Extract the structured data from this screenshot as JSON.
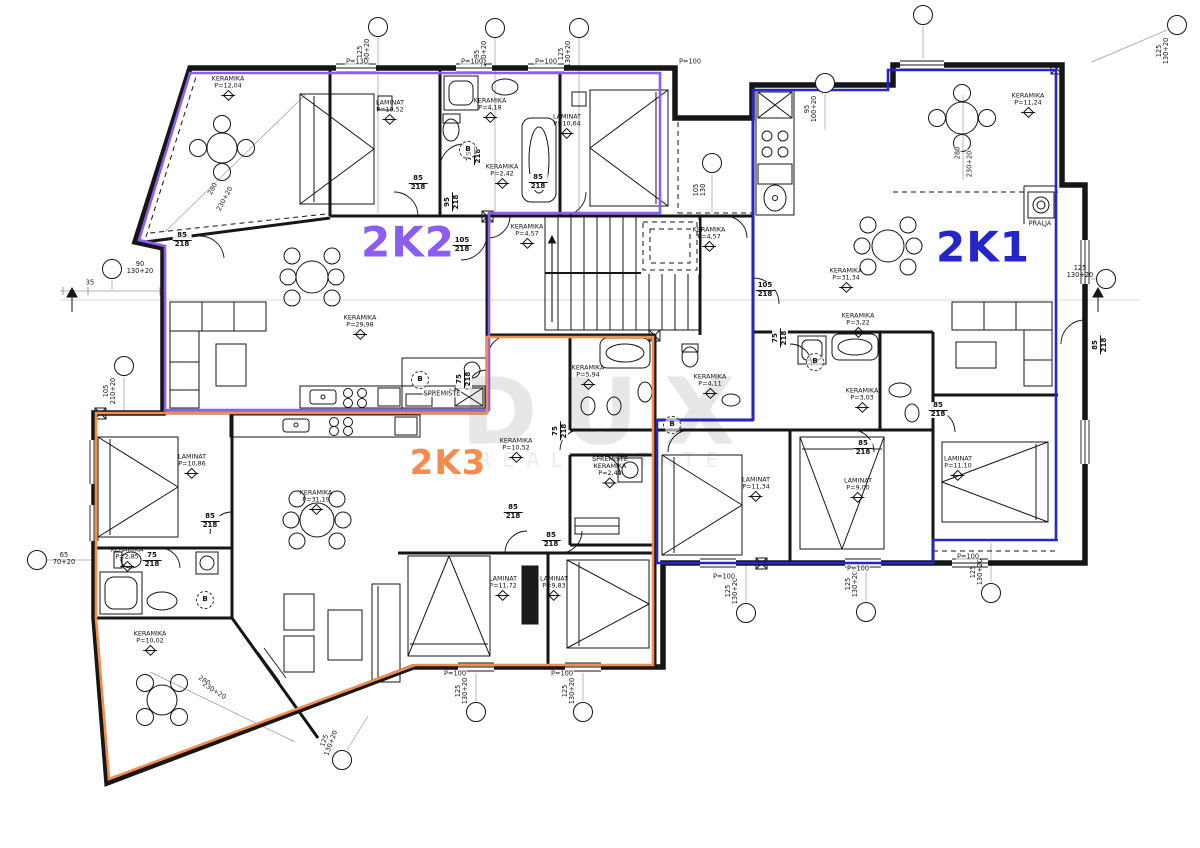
{
  "units": [
    {
      "id": "2K2",
      "color": "#8B5CF6",
      "x": 408,
      "y": 242,
      "size": 42
    },
    {
      "id": "2K1",
      "color": "#2525CE",
      "x": 983,
      "y": 247,
      "size": 42
    },
    {
      "id": "2K3",
      "color": "#F68B4E",
      "x": 448,
      "y": 463,
      "size": 34
    }
  ],
  "watermark": {
    "line1": "DUX",
    "line2": "REAL ESTATE"
  },
  "room_labels": [
    {
      "floor": "KERAMIKA",
      "area": "P=12,04",
      "x": 228,
      "y": 88
    },
    {
      "floor": "LAMINAT",
      "area": "P=10,52",
      "x": 390,
      "y": 112
    },
    {
      "floor": "KERAMIKA",
      "area": "P=4,18",
      "x": 490,
      "y": 110
    },
    {
      "floor": "LAMINAT",
      "area": "P=10,64",
      "x": 567,
      "y": 126
    },
    {
      "floor": "KERAMIKA",
      "area": "P=2,42",
      "x": 502,
      "y": 176
    },
    {
      "floor": "KERAMIKA",
      "area": "P=29,98",
      "x": 360,
      "y": 327
    },
    {
      "floor": "KERAMIKA",
      "area": "P=4,57",
      "x": 527,
      "y": 236
    },
    {
      "floor": "KERAMIKA",
      "area": "P=4,57",
      "x": 709,
      "y": 239
    },
    {
      "floor": "KERAMIKA",
      "area": "P=11,24",
      "x": 1028,
      "y": 105
    },
    {
      "floor": "KERAMIKA",
      "area": "P=31,34",
      "x": 846,
      "y": 280
    },
    {
      "floor": "KERAMIKA",
      "area": "P=3,22",
      "x": 858,
      "y": 325
    },
    {
      "floor": "KERAMIKA",
      "area": "P=4,11",
      "x": 710,
      "y": 386
    },
    {
      "floor": "KERAMIKA",
      "area": "P=3,03",
      "x": 862,
      "y": 400
    },
    {
      "floor": "LAMINAT",
      "area": "P=11,34",
      "x": 756,
      "y": 489
    },
    {
      "floor": "LAMINAT",
      "area": "P=9,00",
      "x": 858,
      "y": 490
    },
    {
      "floor": "LAMINAT",
      "area": "P=11,10",
      "x": 958,
      "y": 468
    },
    {
      "floor": "KERAMIKA",
      "area": "P=5,94",
      "x": 588,
      "y": 377
    },
    {
      "floor": "SPREMIŠTE KERAMIKA",
      "area": "P=2,40",
      "x": 610,
      "y": 472
    },
    {
      "floor": "KERAMIKA",
      "area": "P=10,52",
      "x": 516,
      "y": 450
    },
    {
      "floor": "KERAMIKA",
      "area": "P=31,19",
      "x": 316,
      "y": 502
    },
    {
      "floor": "LAMINAT",
      "area": "P=10,86",
      "x": 192,
      "y": 466
    },
    {
      "floor": "KERAMIKA",
      "area": "P=2,85",
      "x": 127,
      "y": 559
    },
    {
      "floor": "KERAMIKA",
      "area": "P=10,02",
      "x": 150,
      "y": 643
    },
    {
      "floor": "LAMINAT",
      "area": "P=11,72",
      "x": 503,
      "y": 588
    },
    {
      "floor": "LAMINAT",
      "area": "P=9,83",
      "x": 554,
      "y": 588
    }
  ],
  "door_labels": [
    {
      "top": "85",
      "bottom": "218",
      "x": 418,
      "y": 183,
      "rot": 0
    },
    {
      "top": "75",
      "bottom": "218",
      "x": 474,
      "y": 156,
      "rot": -90
    },
    {
      "top": "85",
      "bottom": "218",
      "x": 538,
      "y": 182,
      "rot": 0
    },
    {
      "top": "95",
      "bottom": "218",
      "x": 452,
      "y": 202,
      "rot": -90
    },
    {
      "top": "85",
      "bottom": "218",
      "x": 182,
      "y": 240,
      "rot": 0
    },
    {
      "top": "105",
      "bottom": "218",
      "x": 462,
      "y": 245,
      "rot": 0
    },
    {
      "top": "105",
      "bottom": "218",
      "x": 765,
      "y": 290,
      "rot": 0
    },
    {
      "top": "75",
      "bottom": "218",
      "x": 780,
      "y": 338,
      "rot": -90
    },
    {
      "top": "85",
      "bottom": "218",
      "x": 938,
      "y": 410,
      "rot": 0
    },
    {
      "top": "85",
      "bottom": "218",
      "x": 863,
      "y": 448,
      "rot": 0
    },
    {
      "top": "85",
      "bottom": "218",
      "x": 210,
      "y": 521,
      "rot": 0
    },
    {
      "top": "75",
      "bottom": "218",
      "x": 152,
      "y": 560,
      "rot": 0
    },
    {
      "top": "75",
      "bottom": "218",
      "x": 560,
      "y": 431,
      "rot": -90
    },
    {
      "top": "75",
      "bottom": "218",
      "x": 464,
      "y": 379,
      "rot": -90
    },
    {
      "top": "85",
      "bottom": "218",
      "x": 513,
      "y": 512,
      "rot": 0
    },
    {
      "top": "85",
      "bottom": "218",
      "x": 551,
      "y": 540,
      "rot": 0
    },
    {
      "top": "85",
      "bottom": "218",
      "x": 1100,
      "y": 345,
      "rot": -90
    }
  ],
  "axis_bubbles": [
    {
      "cx": 378,
      "cy": 27,
      "l1": "125",
      "l2": "130+20",
      "lx": 364,
      "ly": 52,
      "rot": -90
    },
    {
      "cx": 495,
      "cy": 28,
      "l1": "95",
      "l2": "100+20",
      "lx": 481,
      "ly": 54,
      "rot": -90
    },
    {
      "cx": 579,
      "cy": 28,
      "l1": "125",
      "l2": "130+20",
      "lx": 565,
      "ly": 54,
      "rot": -90
    },
    {
      "cx": 825,
      "cy": 83,
      "l1": "95",
      "l2": "100+20",
      "lx": 811,
      "ly": 109,
      "rot": -90
    },
    {
      "cx": 923,
      "cy": 15,
      "l1": "",
      "l2": "",
      "lx": 0,
      "ly": 0,
      "rot": 0
    },
    {
      "cx": 1177,
      "cy": 25,
      "l1": "125",
      "l2": "130+20",
      "lx": 1163,
      "ly": 51,
      "rot": -90
    },
    {
      "cx": 1106,
      "cy": 279,
      "l1": "125",
      "l2": "130+20",
      "lx": 1080,
      "ly": 272,
      "rot": 0
    },
    {
      "cx": 112,
      "cy": 269,
      "l1": "90",
      "l2": "130+20",
      "lx": 140,
      "ly": 268,
      "rot": 0
    },
    {
      "cx": 124,
      "cy": 366,
      "l1": "105",
      "l2": "210+20",
      "lx": 110,
      "ly": 391,
      "rot": -90
    },
    {
      "cx": 37,
      "cy": 560,
      "l1": "65",
      "l2": "70+20",
      "lx": 64,
      "ly": 559,
      "rot": 0
    },
    {
      "cx": 342,
      "cy": 760,
      "l1": "125",
      "l2": "130+20",
      "lx": 328,
      "ly": 742,
      "rot": -70
    },
    {
      "cx": 476,
      "cy": 712,
      "l1": "125",
      "l2": "130+20",
      "lx": 462,
      "ly": 691,
      "rot": -90
    },
    {
      "cx": 583,
      "cy": 712,
      "l1": "125",
      "l2": "130+20",
      "lx": 569,
      "ly": 691,
      "rot": -90
    },
    {
      "cx": 746,
      "cy": 613,
      "l1": "125",
      "l2": "130+20",
      "lx": 732,
      "ly": 591,
      "rot": -90
    },
    {
      "cx": 866,
      "cy": 612,
      "l1": "125",
      "l2": "130+20",
      "lx": 852,
      "ly": 584,
      "rot": -90
    },
    {
      "cx": 991,
      "cy": 593,
      "l1": "125",
      "l2": "130+20",
      "lx": 977,
      "ly": 572,
      "rot": -90
    },
    {
      "cx": 712,
      "cy": 163,
      "l1": "105",
      "l2": "130",
      "lx": 700,
      "ly": 190,
      "rot": -90
    }
  ],
  "small_labels": [
    {
      "text": "P=130",
      "x": 357,
      "y": 62,
      "rot": 0
    },
    {
      "text": "P=100",
      "x": 472,
      "y": 62,
      "rot": 0
    },
    {
      "text": "P=100",
      "x": 546,
      "y": 62,
      "rot": 0
    },
    {
      "text": "P=100",
      "x": 690,
      "y": 62,
      "rot": 0
    },
    {
      "text": "P=100",
      "x": 455,
      "y": 674,
      "rot": 0
    },
    {
      "text": "P=100",
      "x": 562,
      "y": 674,
      "rot": 0
    },
    {
      "text": "P=100",
      "x": 724,
      "y": 577,
      "rot": 0
    },
    {
      "text": "P=100",
      "x": 858,
      "y": 569,
      "rot": 0
    },
    {
      "text": "P=100",
      "x": 968,
      "y": 557,
      "rot": 0
    },
    {
      "text": "35",
      "x": 90,
      "y": 283,
      "rot": 0
    },
    {
      "text": "280",
      "x": 213,
      "y": 189,
      "rot": -62
    },
    {
      "text": "230+20",
      "x": 225,
      "y": 199,
      "rot": -62
    },
    {
      "text": "280",
      "x": 958,
      "y": 153,
      "rot": -90
    },
    {
      "text": "230+20",
      "x": 970,
      "y": 164,
      "rot": -90
    },
    {
      "text": "280",
      "x": 204,
      "y": 681,
      "rot": 33
    },
    {
      "text": "230+20",
      "x": 214,
      "y": 691,
      "rot": 33
    },
    {
      "text": "PRALJA",
      "x": 1040,
      "y": 224,
      "rot": 0
    },
    {
      "text": "SPREMIŠTE",
      "x": 442,
      "y": 394,
      "rot": 0
    }
  ],
  "drain_marks": [
    {
      "label": "B",
      "x": 468,
      "y": 150
    },
    {
      "label": "B",
      "x": 420,
      "y": 380
    },
    {
      "label": "B",
      "x": 672,
      "y": 425
    },
    {
      "label": "B",
      "x": 205,
      "y": 600
    },
    {
      "label": "B",
      "x": 815,
      "y": 362
    }
  ]
}
